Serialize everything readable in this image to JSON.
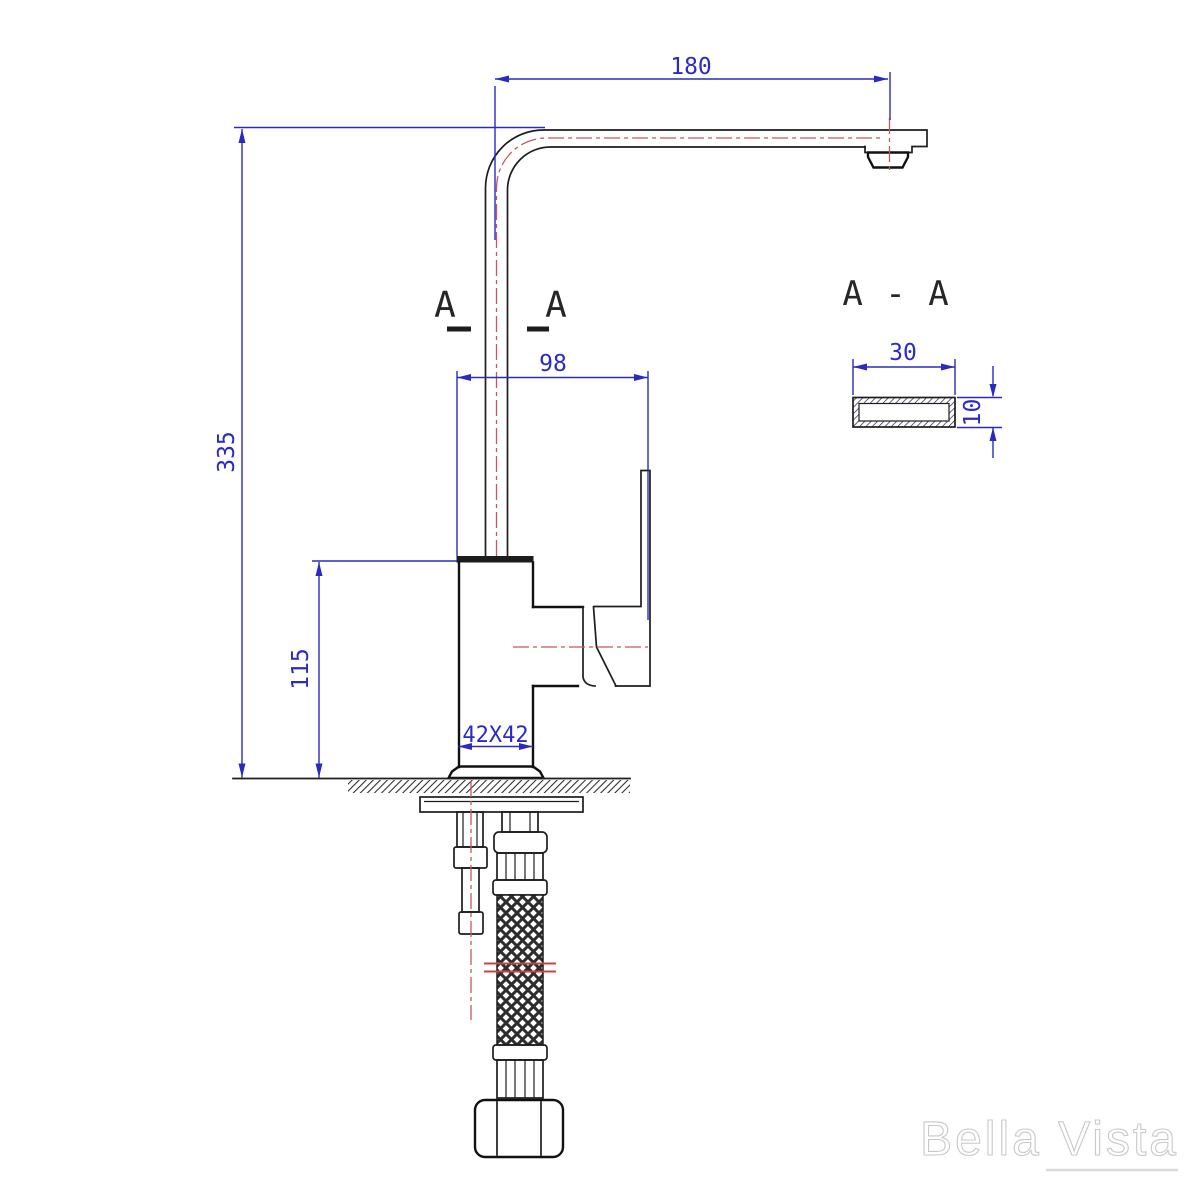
{
  "drawing": {
    "dimensions": {
      "spout_reach": "180",
      "overall_height": "335",
      "spout_offset": "98",
      "handle_height": "115",
      "base_size": "42X42",
      "section_width": "30",
      "section_thickness": "10"
    },
    "section": {
      "marker_left": "A",
      "marker_right": "A",
      "title": "A - A"
    },
    "watermark": "Bella Vista",
    "colors": {
      "dimension_blue": "#2a2ac0",
      "outline_black": "#1d1d1d",
      "centerline_red": "#c25a5a",
      "watermark_gray": "#c9c9c9"
    }
  }
}
